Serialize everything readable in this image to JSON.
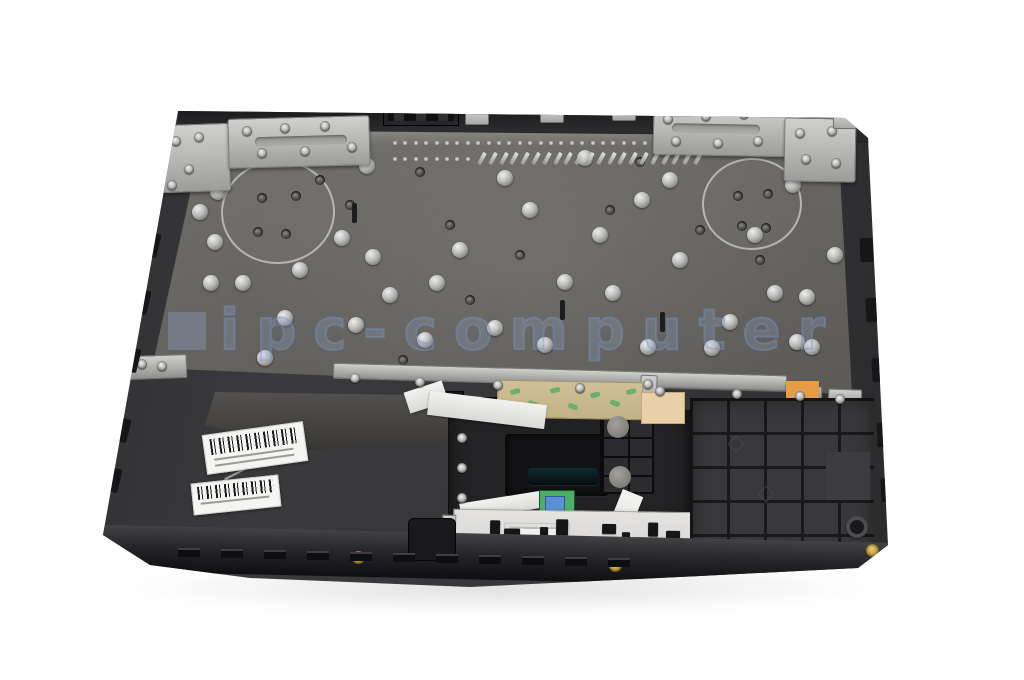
{
  "scene_description": "Laptop palmrest topcase assembly photographed from the inside on a white background, with metal keyboard plate, hinge brackets, touchpad module, button PCB, barcode labels and flex ribbons",
  "watermark": {
    "text": "ipc-computer"
  },
  "colors": {
    "shell": "#323234",
    "plate": "#6b6966",
    "silver": "#c6c7c5",
    "watermark": "#8fa8cc",
    "green": "#4fae66",
    "tape_tan": "#c9ba8c",
    "orange": "#d9882f",
    "pcb_white": "#dedddb",
    "label_white": "#f4f4f2",
    "gold": "#c9a544"
  },
  "scene": {
    "rivets": [
      [
        367,
        166
      ],
      [
        218,
        192
      ],
      [
        200,
        212
      ],
      [
        215,
        242
      ],
      [
        342,
        238
      ],
      [
        373,
        257
      ],
      [
        505,
        178
      ],
      [
        585,
        158
      ],
      [
        670,
        180
      ],
      [
        642,
        200
      ],
      [
        793,
        185
      ],
      [
        835,
        255
      ],
      [
        755,
        235
      ],
      [
        530,
        210
      ],
      [
        600,
        235
      ],
      [
        680,
        260
      ],
      [
        460,
        250
      ],
      [
        300,
        270
      ],
      [
        211,
        283
      ],
      [
        243,
        283
      ],
      [
        285,
        318
      ],
      [
        356,
        325
      ],
      [
        265,
        358
      ],
      [
        425,
        340
      ],
      [
        437,
        283
      ],
      [
        495,
        328
      ],
      [
        545,
        345
      ],
      [
        565,
        282
      ],
      [
        613,
        293
      ],
      [
        648,
        347
      ],
      [
        730,
        322
      ],
      [
        775,
        293
      ],
      [
        797,
        342
      ],
      [
        858,
        320
      ],
      [
        712,
        348
      ],
      [
        807,
        297
      ],
      [
        812,
        347
      ],
      [
        390,
        295
      ]
    ],
    "plate_holes": [
      [
        350,
        205
      ],
      [
        450,
        225
      ],
      [
        610,
        210
      ],
      [
        700,
        230
      ],
      [
        640,
        162
      ],
      [
        420,
        172
      ],
      [
        520,
        255
      ],
      [
        760,
        260
      ],
      [
        250,
        160
      ],
      [
        320,
        180
      ],
      [
        262,
        198
      ],
      [
        296,
        196
      ],
      [
        258,
        232
      ],
      [
        286,
        234
      ],
      [
        738,
        196
      ],
      [
        768,
        194
      ],
      [
        742,
        226
      ],
      [
        766,
        228
      ],
      [
        403,
        360
      ],
      [
        470,
        300
      ]
    ],
    "plate_slots": [
      [
        352,
        203
      ],
      [
        560,
        300
      ],
      [
        660,
        312
      ]
    ],
    "pin_rows": [
      {
        "x": 393,
        "y": 141,
        "count": 30,
        "step": 10.4,
        "kind": "dot"
      },
      {
        "x": 393,
        "y": 157,
        "count": 8,
        "step": 10.4,
        "kind": "dot"
      },
      {
        "x": 480,
        "y": 152,
        "count": 21,
        "step": 10.8,
        "kind": "slash"
      }
    ],
    "screws": [
      [
        247,
        131
      ],
      [
        285,
        128
      ],
      [
        325,
        126
      ],
      [
        352,
        147
      ],
      [
        305,
        151
      ],
      [
        262,
        153
      ],
      [
        176,
        141
      ],
      [
        199,
        137
      ],
      [
        189,
        169
      ],
      [
        172,
        185
      ],
      [
        668,
        119
      ],
      [
        706,
        116
      ],
      [
        744,
        114
      ],
      [
        676,
        141
      ],
      [
        718,
        143
      ],
      [
        758,
        141
      ],
      [
        800,
        133
      ],
      [
        832,
        131
      ],
      [
        806,
        159
      ],
      [
        836,
        163
      ],
      [
        355,
        378
      ],
      [
        420,
        382
      ],
      [
        498,
        385
      ],
      [
        580,
        388
      ],
      [
        660,
        391
      ],
      [
        737,
        394
      ],
      [
        800,
        396
      ],
      [
        840,
        399
      ],
      [
        142,
        364
      ],
      [
        162,
        366
      ],
      [
        648,
        384
      ],
      [
        462,
        438
      ],
      [
        462,
        468
      ],
      [
        462,
        498
      ]
    ],
    "gold_screws": [
      [
        358,
        557
      ],
      [
        872,
        550
      ],
      [
        615,
        565
      ]
    ],
    "clips": {
      "x": 178,
      "y": 548,
      "count": 11,
      "step": 43,
      "dy": 1.0
    },
    "nubs_left": [
      [
        146,
        233
      ],
      [
        136,
        290
      ],
      [
        126,
        348
      ],
      [
        116,
        418
      ],
      [
        107,
        468
      ]
    ],
    "nubs_right": [
      [
        860,
        238
      ],
      [
        866,
        298
      ],
      [
        872,
        358
      ],
      [
        877,
        423
      ],
      [
        881,
        478
      ]
    ],
    "rim_tabs": [
      [
        465,
        109
      ],
      [
        540,
        107
      ],
      [
        612,
        105
      ],
      [
        833,
        113
      ]
    ],
    "rim_slots": [
      [
        582,
        104
      ],
      [
        650,
        103
      ]
    ],
    "grid_circles": [
      [
        618,
        427
      ],
      [
        620,
        477
      ]
    ],
    "tape_marks": [
      [
        12,
        8
      ],
      [
        30,
        20
      ],
      [
        52,
        6
      ],
      [
        70,
        22
      ],
      [
        92,
        10
      ],
      [
        112,
        18
      ],
      [
        128,
        6
      ]
    ],
    "pcb": {
      "components": [
        [
          36,
          10,
          10,
          14
        ],
        [
          50,
          18,
          16,
          8
        ],
        [
          86,
          16,
          8,
          10
        ],
        [
          102,
          8,
          12,
          16
        ],
        [
          148,
          12,
          14,
          10
        ],
        [
          168,
          20,
          8,
          8
        ],
        [
          194,
          10,
          10,
          14
        ],
        [
          212,
          18,
          14,
          8
        ],
        [
          248,
          12,
          10,
          12
        ],
        [
          266,
          8,
          8,
          14
        ],
        [
          290,
          16,
          12,
          8
        ],
        [
          58,
          30,
          10,
          6
        ],
        [
          228,
          32,
          12,
          6
        ],
        [
          306,
          12,
          8,
          12
        ]
      ],
      "screw_xs": [
        14,
        44,
        74,
        104,
        134,
        164,
        194,
        228,
        258,
        288,
        308
      ],
      "screw_y": 40
    }
  }
}
